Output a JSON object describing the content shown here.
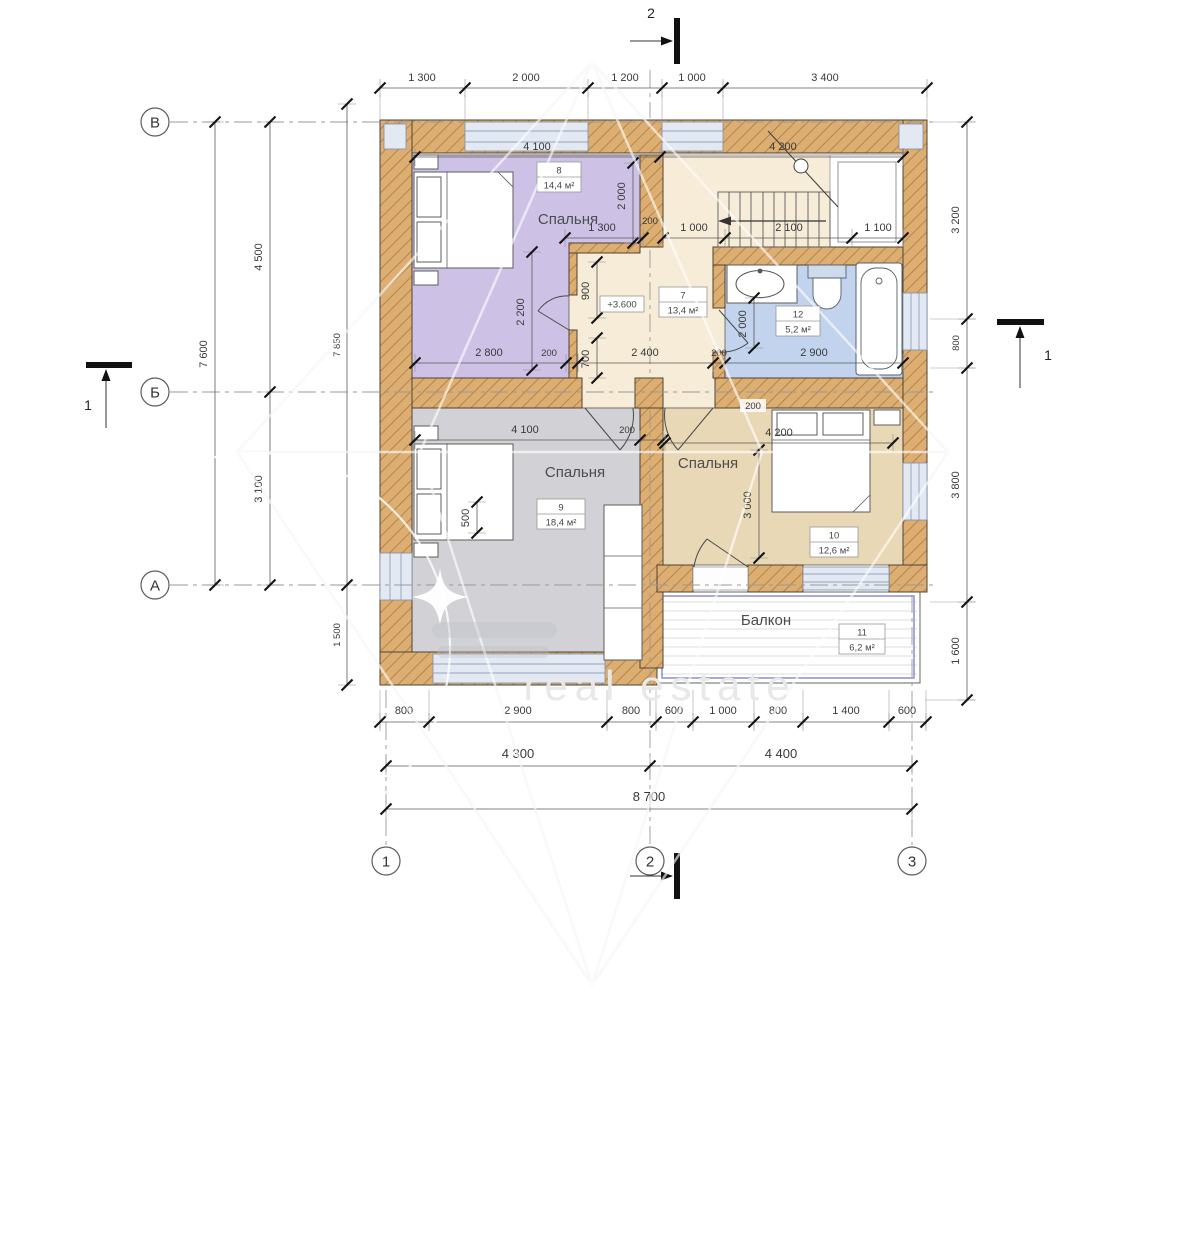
{
  "watermark": {
    "text": "real estate"
  },
  "axes": {
    "v": "В",
    "b": "Б",
    "a": "А",
    "c1": "1",
    "c2": "2",
    "c3": "3"
  },
  "sections": {
    "one": "1",
    "two": "2"
  },
  "level_mark": "+3.600",
  "rooms": {
    "room8": {
      "number": "8",
      "name": "Спальня",
      "area": "14,4 м²"
    },
    "room7": {
      "number": "7",
      "name": "",
      "area": "13,4 м²"
    },
    "room12": {
      "number": "12",
      "name": "",
      "area": "5,2 м²"
    },
    "room9": {
      "number": "9",
      "name": "Спальня",
      "area": "18,4 м²"
    },
    "room10": {
      "number": "10",
      "name": "Спальня",
      "area": "12,6 м²"
    },
    "room11": {
      "number": "11",
      "name": "Балкон",
      "area": "6,2 м²"
    }
  },
  "dims": {
    "top": [
      "1 300",
      "2 000",
      "1 200",
      "1 000",
      "3 400"
    ],
    "room8_w": "4 100",
    "stair_w": "4 200",
    "room8_right": "2 000",
    "notch_w": "1 300",
    "wall200": "200",
    "stairs": [
      "1 000",
      "2 100",
      "1 100"
    ],
    "room8_h": "2 200",
    "alcove_h": "900",
    "alcove_b": "700",
    "mid_row": [
      "2 800",
      "200",
      "2 400",
      "200",
      "2 900"
    ],
    "bath_h": "2 000",
    "room9_w": "4 100",
    "room9_wall": "200",
    "room9_v": "500",
    "room10_w": "4 200",
    "room10_h": "3 000",
    "room10_wall": "200",
    "left_total": "7 600",
    "left": [
      "4 500",
      "3 100"
    ],
    "left_inner": [
      "7 850",
      "1 500"
    ],
    "right": [
      "3 200",
      "800",
      "3 800",
      "1 600"
    ],
    "bottom1": [
      "800",
      "2 900",
      "800",
      "600",
      "1 000",
      "800",
      "1 400",
      "600"
    ],
    "bottom2": [
      "4 300",
      "4 400"
    ],
    "bottom3": "8 700"
  }
}
